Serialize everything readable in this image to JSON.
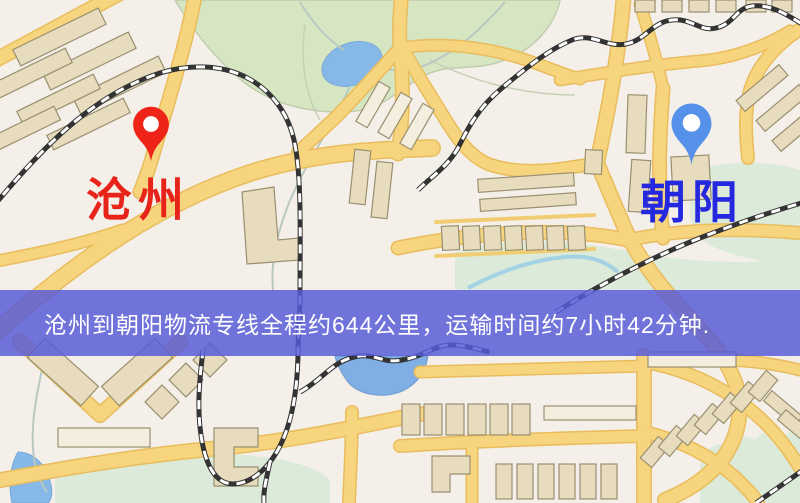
{
  "map": {
    "origin": {
      "name": "沧州",
      "pin_color": "#ee2418",
      "label_color": "#e8231a"
    },
    "destination": {
      "name": "朝阳",
      "pin_color": "#5590ea",
      "label_color": "#2428de"
    }
  },
  "banner": {
    "text": "沧州到朝阳物流专线全程约644公里，运输时间约7小时42分钟.",
    "route": {
      "from": "沧州",
      "to": "朝阳",
      "distance": "约644公里",
      "duration": "约7小时42分钟"
    },
    "background_color": "#565ad6",
    "text_color": "#ffffff"
  }
}
